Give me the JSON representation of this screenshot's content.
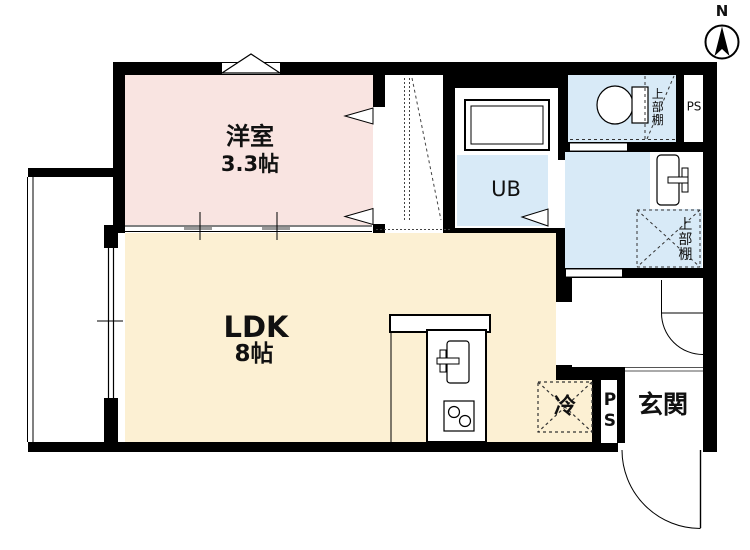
{
  "compass": {
    "north_label": "N"
  },
  "rooms": {
    "western_room": {
      "name": "洋室",
      "size": "3.3帖"
    },
    "ldk": {
      "name": "LDK",
      "size": "8帖"
    },
    "unit_bath": {
      "name": "UB"
    },
    "entrance": {
      "name": "玄関"
    }
  },
  "fixtures": {
    "refrigerator_label": "冷",
    "pipe_space_top": "PS",
    "pipe_space_bottom": "PS",
    "upper_shelf_toilet": "上部棚",
    "upper_shelf_washroom": "上部棚"
  },
  "colors": {
    "wall": "#000000",
    "western-room": "#f9e4e1",
    "ldk": "#fcf0d3",
    "wet-area": "#d8eaf7",
    "line-gray": "#999999"
  }
}
